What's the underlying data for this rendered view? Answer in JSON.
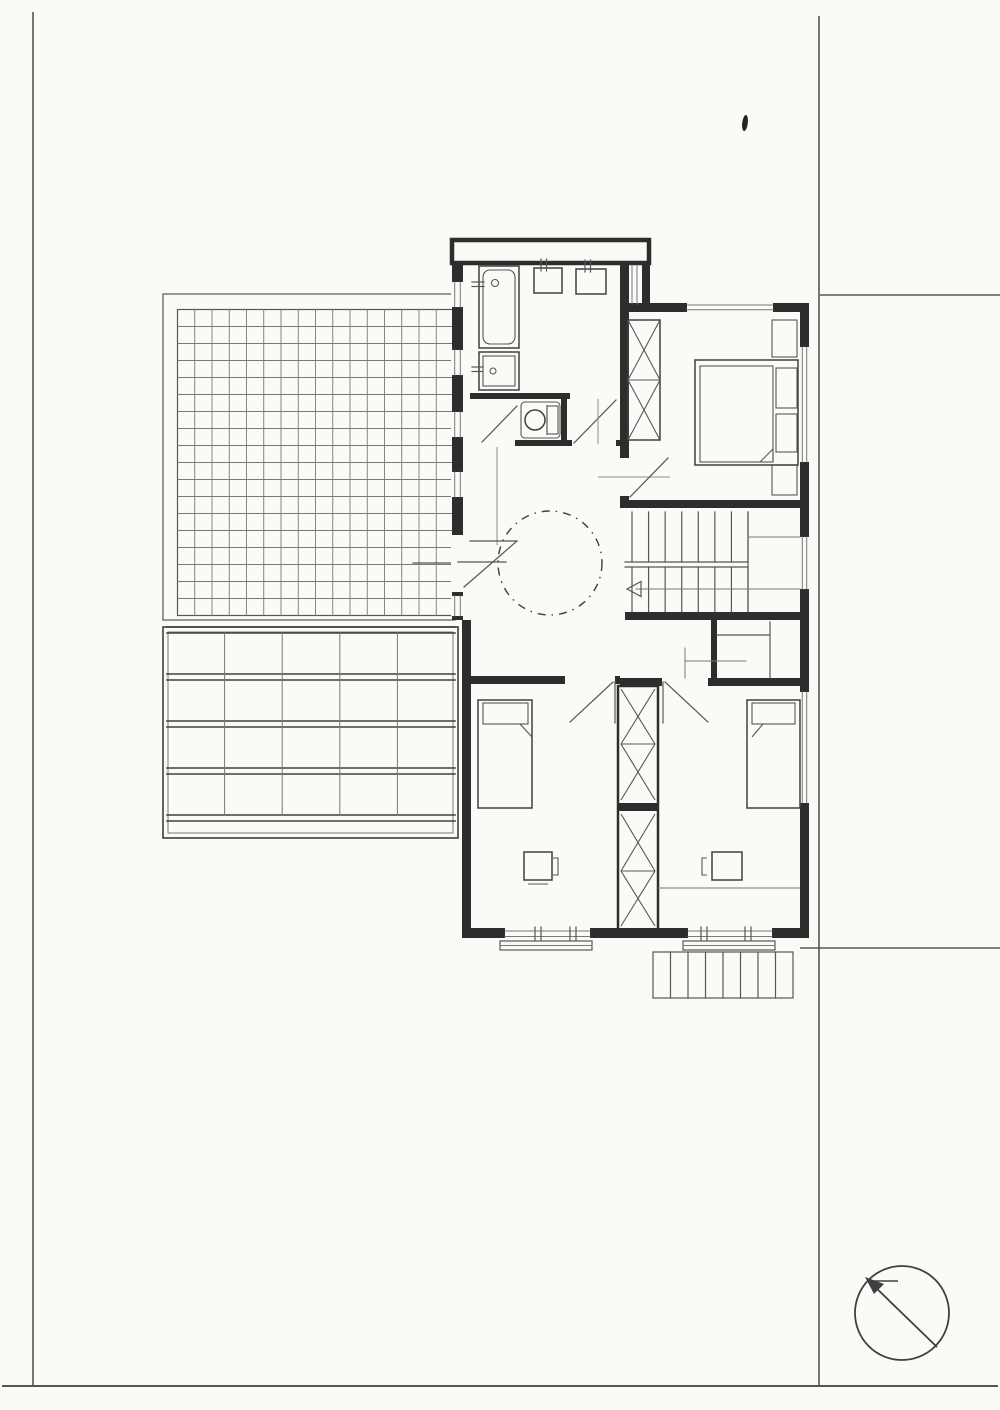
{
  "document": {
    "kind": "scanned architectural drawing",
    "view": "upper floor plan with site boundary lines",
    "visible_text": [],
    "paper_color": "#fbfaf7"
  },
  "colors": {
    "wall_ink": "#2d2d2d",
    "line_dark": "#3f3f3f",
    "line_medium": "#565656",
    "line_light": "#787878",
    "line_faint": "#8c8c8c"
  },
  "plan": {
    "terrace": {
      "tile_cols": 16,
      "tile_rows": 18
    },
    "pergola": {
      "beam_rows": 4,
      "bay_cols": 5
    },
    "staircase": {
      "flights": 2,
      "treads_per_flight": 8,
      "has_direction_arrow": true
    },
    "shutter_box_slats": 8,
    "rooms": [
      "bathroom",
      "wc",
      "hall",
      "master-bedroom",
      "stairwell",
      "closet",
      "bedroom-left",
      "bedroom-right"
    ],
    "fixtures": [
      "bathtub",
      "shower-tray",
      "washbasin",
      "washbasin",
      "toilet",
      "double-bed",
      "single-bed",
      "single-bed",
      "desk",
      "desk",
      "wardrobe",
      "wardrobe",
      "wardrobe"
    ],
    "symbols": [
      "north-arrow",
      "dashed-circle-rooflight",
      "door-swings",
      "property-boundary-lines",
      "ink-blot"
    ]
  }
}
